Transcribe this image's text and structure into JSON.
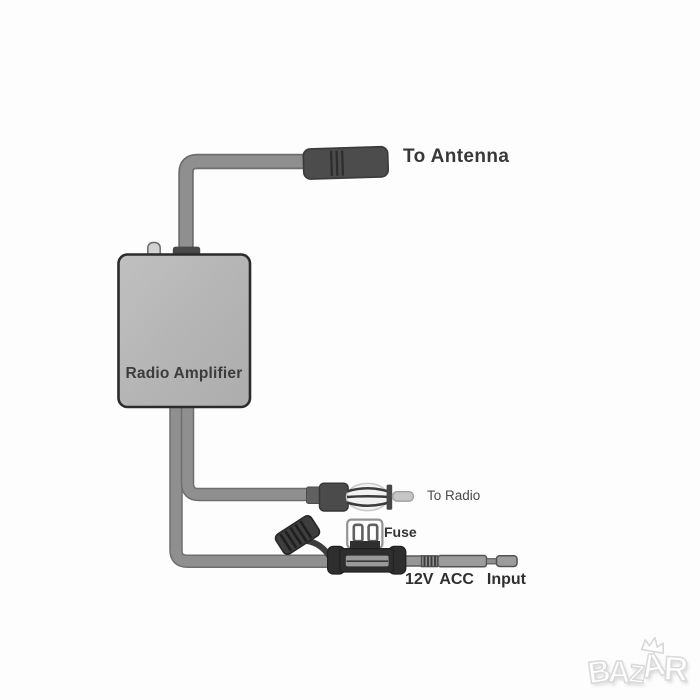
{
  "diagram": {
    "kind": "car radio amplifier wiring diagram",
    "device_label": "Radio Amplifier"
  },
  "labels": {
    "to_antenna": "To Antenna",
    "radio_amplifier": "Radio Amplifier",
    "to_radio": "To Radio",
    "fuse": "Fuse",
    "power_input": "12V ACC  Input"
  },
  "components": [
    {
      "name": "antenna-connector",
      "connects_to": "To Antenna"
    },
    {
      "name": "amplifier-box",
      "label": "Radio Amplifier"
    },
    {
      "name": "radio-din-plug",
      "connects_to": "To Radio"
    },
    {
      "name": "inline-fuse-holder",
      "label": "Fuse"
    },
    {
      "name": "power-lead",
      "label": "12V ACC Input"
    }
  ],
  "watermark": {
    "text": "BAZAR"
  },
  "colors": {
    "background": "#fdfdfd",
    "cable_fill": "#8f8f8f",
    "cable_outline": "#6e6e6e",
    "connector_dark": "#4b4b4b",
    "box_fill": "#b5b5b5",
    "box_border": "#2b2b2b",
    "fuse_holder": "#2e2e2e",
    "label_text": "#383838"
  }
}
